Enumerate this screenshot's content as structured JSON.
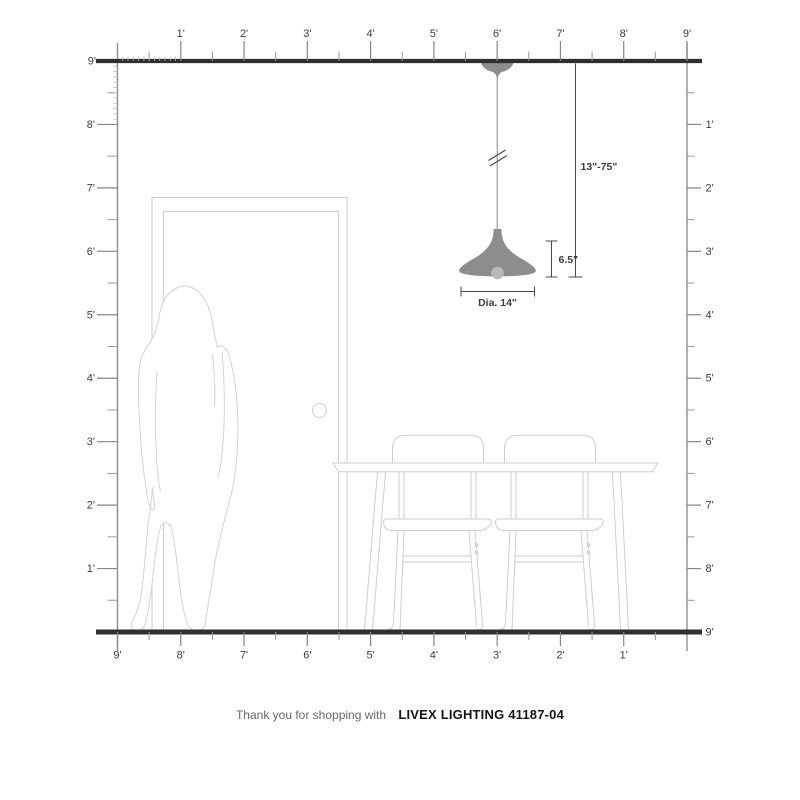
{
  "title": "Pendant light scale diagram",
  "rulers": {
    "unit": "feet",
    "top": {
      "labels": [
        "1'",
        "2'",
        "3'",
        "4'",
        "5'",
        "6'",
        "7'",
        "8'",
        "9'"
      ]
    },
    "left": {
      "labels": [
        "9'",
        "8'",
        "7'",
        "6'",
        "5'",
        "4'",
        "3'",
        "2'",
        "1'"
      ]
    },
    "right": {
      "labels": [
        "1'",
        "2'",
        "3'",
        "4'",
        "5'",
        "6'",
        "7'",
        "8'",
        "9'"
      ]
    },
    "bottom": {
      "labels": [
        "9'",
        "8'",
        "7'",
        "6'",
        "5'",
        "4'",
        "3'",
        "2'",
        "1'"
      ]
    },
    "top_left_corner_label": "9'"
  },
  "dimensions": {
    "drop_range": "13\"-75\"",
    "shade_height": "6.5\"",
    "diameter": "Dia. 14\""
  },
  "caption": {
    "prefix": "Thank you for shopping with",
    "product": "LIVEX LIGHTING 41187-04"
  },
  "colors": {
    "background": "#ffffff",
    "ceiling_floor": "#2f2f2f",
    "ruler": "#8e8e8e",
    "ruler_label": "#3d3d3d",
    "scene_outline": "#cdced1",
    "pendant_metal": "#8d8d8d",
    "bulb": "#b9b9b9",
    "dimension": "#4a4a4a",
    "caption_prefix": "#686868",
    "caption_product": "#161616"
  }
}
